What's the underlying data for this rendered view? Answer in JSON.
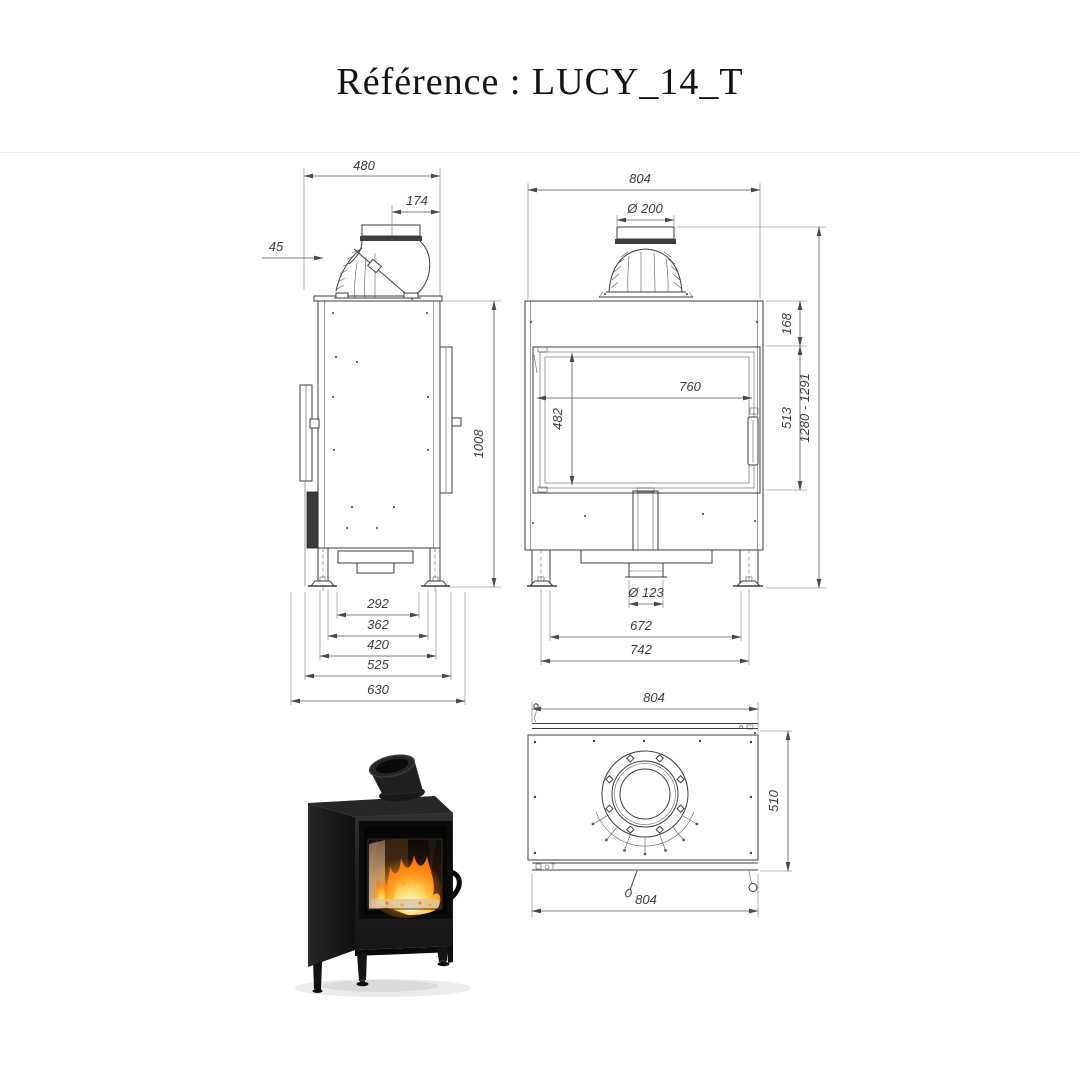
{
  "page": {
    "title": "Référence : LUCY_14_T"
  },
  "views": {
    "side": {
      "dims": {
        "total_depth_top": "480",
        "flue_to_front": "174",
        "rear_clearance": "45",
        "height_body": "1008",
        "feet_span_inner": "292",
        "legs_span_inner": "362",
        "legs_span_outer": "420",
        "base_depth": "525",
        "total_depth_floor": "630"
      }
    },
    "front": {
      "dims": {
        "total_width": "804",
        "flue_diameter": "Ø 200",
        "top_band_height": "168",
        "glass_width": "760",
        "glass_height": "482",
        "door_height": "513",
        "total_height_range": "1280 - 1291",
        "air_inlet_diameter": "Ø 123",
        "legs_span_inner": "672",
        "legs_span_axes": "742"
      }
    },
    "top": {
      "dims": {
        "width_back": "804",
        "depth": "510",
        "width_front": "804"
      }
    }
  },
  "photo": {
    "caption": "LUCY 14 T black steel stove, fire burning behind glass door"
  },
  "colors": {
    "background": "#ffffff",
    "drawing_line": "#3e3e3e",
    "dim_text": "#3c3c3c",
    "stove_black": "#1d1d1d",
    "flame_orange": "#ff8a1e",
    "flame_yellow": "#ffd24a"
  }
}
